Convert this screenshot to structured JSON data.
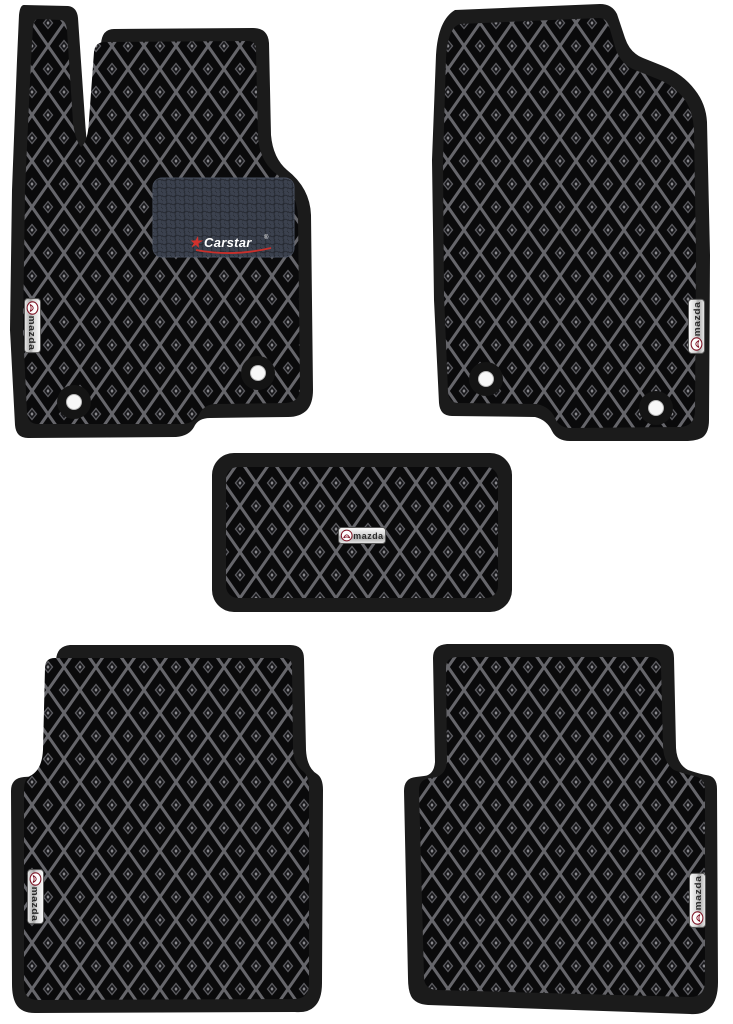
{
  "product": {
    "name": "EVA car floor mat set",
    "piece_count": 5,
    "mats": [
      {
        "id": "front-left",
        "badge": "mazda",
        "heel_pad_brand": "Carstar",
        "fixation_holes": 2
      },
      {
        "id": "front-right",
        "badge": "mazda",
        "fixation_holes": 2
      },
      {
        "id": "center-tunnel",
        "badge": "mazda",
        "fixation_holes": 0
      },
      {
        "id": "rear-left",
        "badge": "mazda",
        "fixation_holes": 0
      },
      {
        "id": "rear-right",
        "badge": "mazda",
        "fixation_holes": 0
      }
    ]
  },
  "badge": {
    "label": "mazda"
  },
  "patch": {
    "star_icon": "★",
    "brand_label": "Carstar",
    "registered_mark": "®"
  },
  "colors": {
    "page_background": "#ffffff",
    "mat_border": "#1b1b1b",
    "mat_base": "#0a0a0b",
    "pattern_lattice": "#66666b",
    "heel_pad": "#3b414e",
    "brand_red": "#c9302b",
    "mazda_maroon": "#7e1425",
    "badge_chrome": "#d9d9d9",
    "hole_white": "#f7f7f7"
  }
}
